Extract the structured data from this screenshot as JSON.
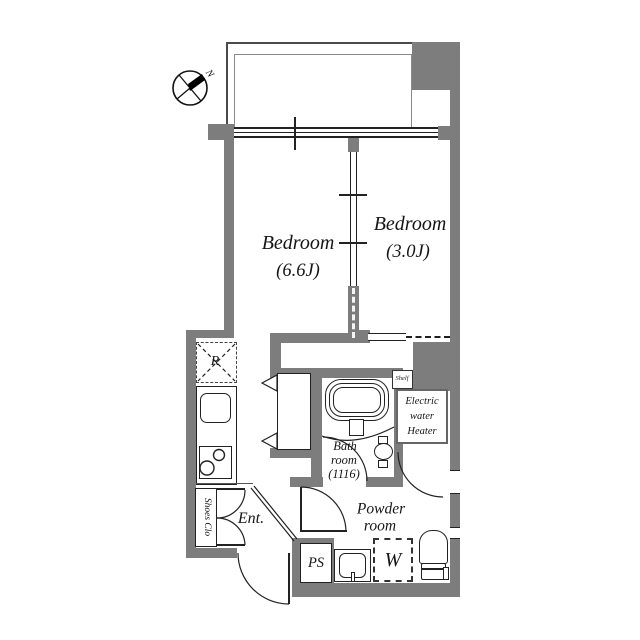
{
  "compass": {
    "north_label": "N"
  },
  "rooms": {
    "bedroom_main": {
      "name": "Bedroom",
      "size": "(6.6J)"
    },
    "bedroom_second": {
      "name": "Bedroom",
      "size": "(3.0J)"
    },
    "bathroom": {
      "line1": "Bath",
      "line2": "room",
      "line3": "(1116)"
    },
    "powder_room": {
      "line1": "Powder",
      "line2": "room"
    },
    "entrance": {
      "label": "Ent."
    }
  },
  "features": {
    "refrigerator_label": "R",
    "washer_label": "W",
    "pipe_space_label": "PS",
    "shoes_closet_label": "Shoes Clo",
    "shelf_label": "Shelf",
    "water_heater": {
      "line1": "Electric",
      "line2": "water",
      "line3": "Heater"
    }
  },
  "colors": {
    "wall": "#7d7d7d",
    "line": "#222222",
    "background": "#ffffff"
  }
}
